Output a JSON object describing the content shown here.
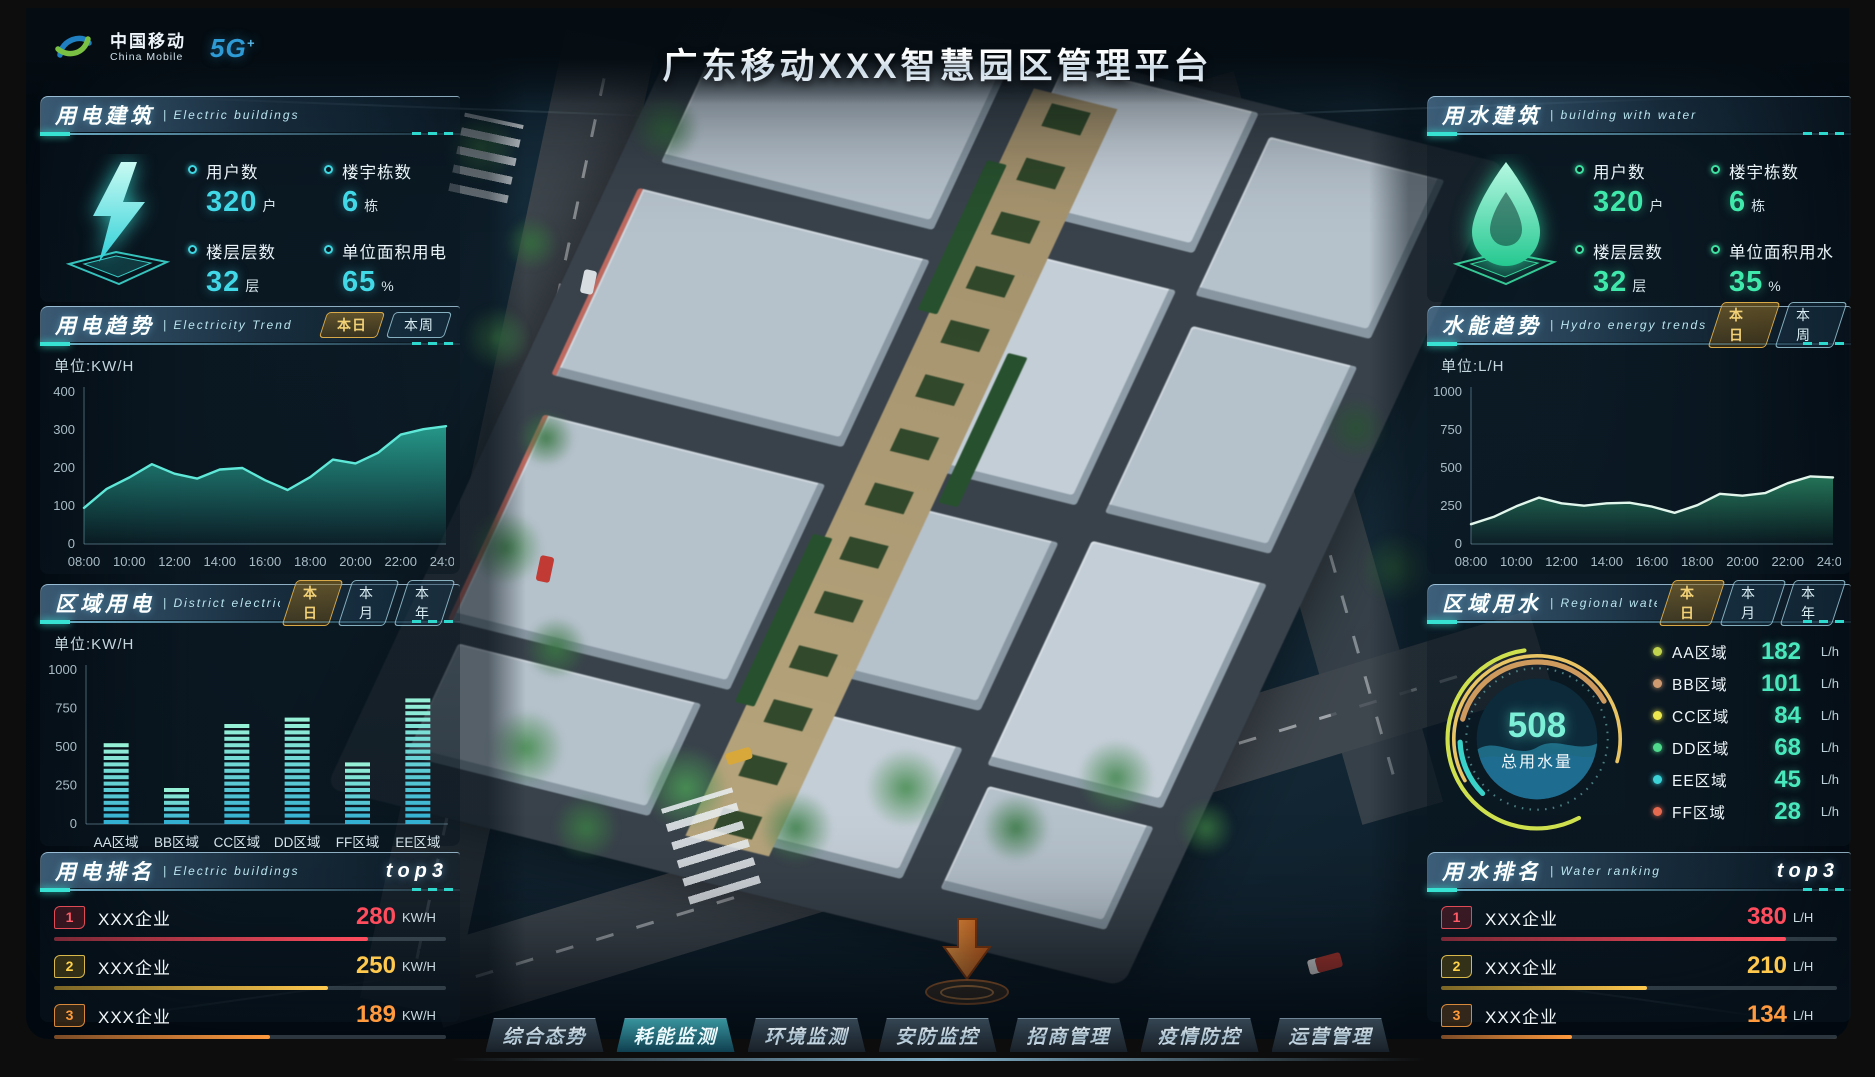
{
  "header": {
    "logo_zh": "中国移动",
    "logo_en": "China Mobile",
    "logo_5g": "5G",
    "logo_5g_plus": "+",
    "title": "广东移动XXX智慧园区管理平台"
  },
  "electric_building": {
    "title": "用电建筑",
    "subtitle": "| Electric buildings",
    "accent_color": "#41d8e8",
    "stats": [
      {
        "label": "用户数",
        "value": "320",
        "unit": "户"
      },
      {
        "label": "楼宇栋数",
        "value": "6",
        "unit": "栋"
      },
      {
        "label": "楼层层数",
        "value": "32",
        "unit": "层"
      },
      {
        "label": "单位面积用电",
        "value": "65",
        "unit": "%"
      }
    ]
  },
  "water_building": {
    "title": "用水建筑",
    "subtitle": "| building with water",
    "accent_color": "#3fe8ab",
    "stats": [
      {
        "label": "用户数",
        "value": "320",
        "unit": "户"
      },
      {
        "label": "楼宇栋数",
        "value": "6",
        "unit": "栋"
      },
      {
        "label": "楼层层数",
        "value": "32",
        "unit": "层"
      },
      {
        "label": "单位面积用水",
        "value": "35",
        "unit": "%"
      }
    ]
  },
  "electricity_trend": {
    "title": "用电趋势",
    "subtitle": "| Electricity Trend",
    "tabs": [
      "本日",
      "本周"
    ],
    "active_tab": "本日"
  },
  "hydro_trend": {
    "title": "水能趋势",
    "subtitle": "| Hydro energy trends",
    "tabs": [
      "本日",
      "本周"
    ],
    "active_tab": "本日"
  },
  "district_electricity": {
    "title": "区域用电",
    "subtitle": "| District electricity",
    "tabs": [
      "本日",
      "本月",
      "本年"
    ],
    "active_tab": "本日"
  },
  "regional_water": {
    "title": "区域用水",
    "subtitle": "| Regional water",
    "tabs": [
      "本日",
      "本月",
      "本年"
    ],
    "active_tab": "本日",
    "total_value": "508",
    "total_label": "总用水量",
    "legend": [
      {
        "name": "AA区域",
        "value": "182",
        "unit": "L/h"
      },
      {
        "name": "BB区域",
        "value": "101",
        "unit": "L/h"
      },
      {
        "name": "CC区域",
        "value": "84",
        "unit": "L/h"
      },
      {
        "name": "DD区域",
        "value": "68",
        "unit": "L/h"
      },
      {
        "name": "EE区域",
        "value": "45",
        "unit": "L/h"
      },
      {
        "name": "FF区域",
        "value": "28",
        "unit": "L/h"
      }
    ]
  },
  "electric_ranking": {
    "title": "用电排名",
    "subtitle": "| Electric buildings",
    "top3": "top3",
    "rows": [
      {
        "rank": "1",
        "name": "XXX企业",
        "value": "280",
        "unit": "KW/H"
      },
      {
        "rank": "2",
        "name": "XXX企业",
        "value": "250",
        "unit": "KW/H"
      },
      {
        "rank": "3",
        "name": "XXX企业",
        "value": "189",
        "unit": "KW/H"
      }
    ]
  },
  "water_ranking": {
    "title": "用水排名",
    "subtitle": "| Water ranking",
    "top3": "top3",
    "rows": [
      {
        "rank": "1",
        "name": "XXX企业",
        "value": "380",
        "unit": "L/H"
      },
      {
        "rank": "2",
        "name": "XXX企业",
        "value": "210",
        "unit": "L/H"
      },
      {
        "rank": "3",
        "name": "XXX企业",
        "value": "134",
        "unit": "L/H"
      }
    ]
  },
  "nav": {
    "items": [
      "综合态势",
      "耗能监测",
      "环境监测",
      "安防监控",
      "招商管理",
      "疫情防控",
      "运营管理"
    ],
    "active_index": 1
  },
  "chart_data": [
    {
      "id": "electricity-trend",
      "type": "area",
      "title": "用电趋势 (本日)",
      "ylabel": "单位:KW/H",
      "x": [
        "08:00",
        "09:00",
        "10:00",
        "11:00",
        "12:00",
        "13:00",
        "14:00",
        "15:00",
        "16:00",
        "17:00",
        "18:00",
        "19:00",
        "20:00",
        "21:00",
        "22:00",
        "23:00",
        "24:00"
      ],
      "values": [
        95,
        145,
        175,
        210,
        185,
        172,
        196,
        200,
        168,
        142,
        176,
        222,
        212,
        240,
        288,
        302,
        310
      ],
      "ylim": [
        0,
        400
      ],
      "yticks": [
        0,
        100,
        200,
        300,
        400
      ],
      "xticks": [
        "08:00",
        "10:00",
        "12:00",
        "14:00",
        "16:00",
        "18:00",
        "20:00",
        "22:00",
        "24:00"
      ],
      "grid": false,
      "line_color": "#5fe8d8",
      "fill_color": "#2fc8b0"
    },
    {
      "id": "hydro-trend",
      "type": "area",
      "title": "水能趋势 (本日)",
      "ylabel": "单位:L/H",
      "x": [
        "08:00",
        "09:00",
        "10:00",
        "11:00",
        "12:00",
        "13:00",
        "14:00",
        "15:00",
        "16:00",
        "17:00",
        "18:00",
        "19:00",
        "20:00",
        "21:00",
        "22:00",
        "23:00",
        "24:00"
      ],
      "values": [
        130,
        178,
        248,
        305,
        268,
        252,
        268,
        272,
        246,
        205,
        255,
        330,
        318,
        335,
        400,
        445,
        438
      ],
      "ylim": [
        0,
        1000
      ],
      "yticks": [
        0,
        250,
        500,
        750,
        1000
      ],
      "xticks": [
        "08:00",
        "10:00",
        "12:00",
        "14:00",
        "16:00",
        "18:00",
        "20:00",
        "22:00",
        "24:00"
      ],
      "grid": false,
      "line_color": "#e2f6ec",
      "fill_color": "#2f9a70"
    },
    {
      "id": "district-electricity",
      "type": "bar",
      "title": "区域用电 (本日)",
      "ylabel": "单位:KW/H",
      "categories": [
        "AA区域",
        "BB区域",
        "CC区域",
        "DD区域",
        "FF区域",
        "EE区域"
      ],
      "values": [
        560,
        290,
        690,
        720,
        430,
        850
      ],
      "ylim": [
        0,
        1000
      ],
      "yticks": [
        0,
        250,
        500,
        750,
        1000
      ],
      "grid": false,
      "bar_color_bottom": "#34b0d2",
      "bar_color_top": "#96f0d6"
    },
    {
      "id": "regional-water",
      "type": "pie",
      "title": "区域用水 (本日)",
      "total": 508,
      "total_label": "总用水量",
      "unit": "L/h",
      "segments": [
        {
          "name": "AA区域",
          "value": 182,
          "color": "#c2d44e"
        },
        {
          "name": "BB区域",
          "value": 101,
          "color": "#cf9a70"
        },
        {
          "name": "CC区域",
          "value": 84,
          "color": "#ede84e"
        },
        {
          "name": "DD区域",
          "value": 68,
          "color": "#4ed98c"
        },
        {
          "name": "EE区域",
          "value": 45,
          "color": "#3bd2d8"
        },
        {
          "name": "FF区域",
          "value": 28,
          "color": "#e56a4f"
        }
      ]
    }
  ]
}
